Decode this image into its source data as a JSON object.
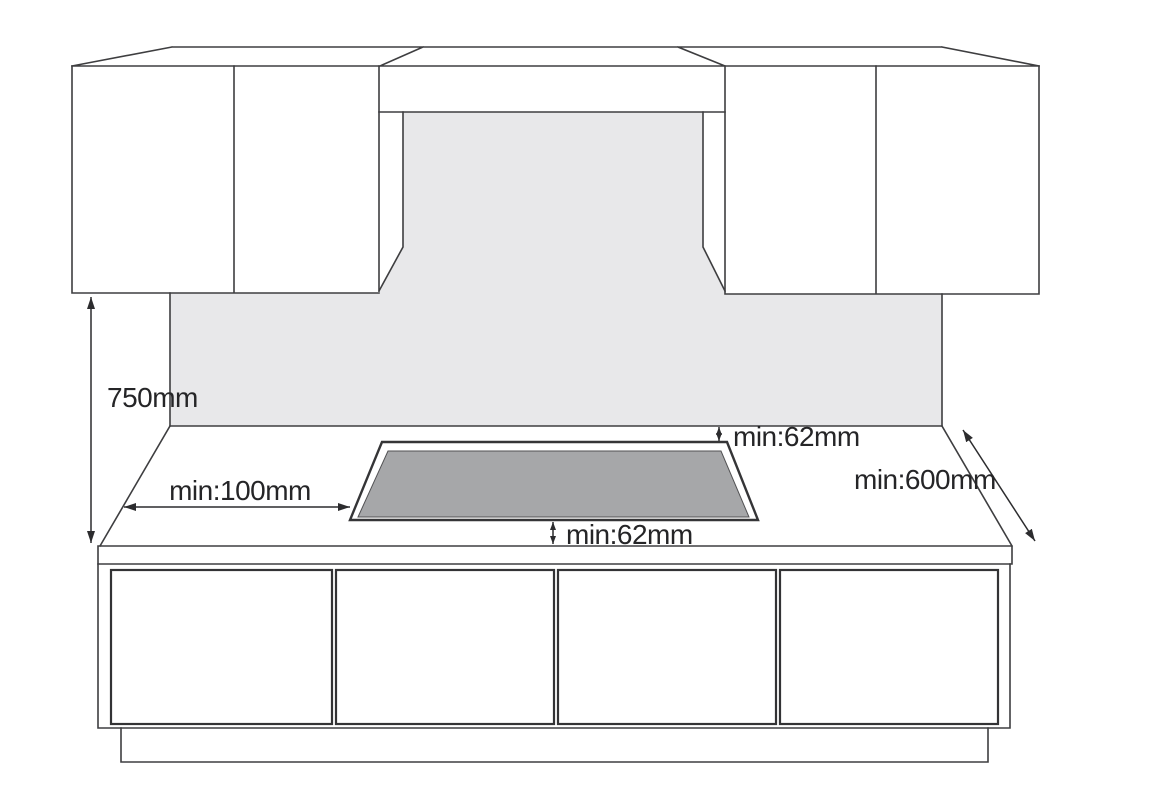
{
  "diagram": {
    "labels": {
      "cabinet_height_clearance": "750mm",
      "side_clearance": "min:100mm",
      "rear_clearance": "min:62mm",
      "front_clearance": "min:62mm",
      "worktop_depth": "min:600mm"
    },
    "colors": {
      "background": "#ffffff",
      "wall": "#e8e8ea",
      "hob_surface": "#a6a7a9",
      "line": "#3e3e40",
      "text": "#252527"
    }
  }
}
